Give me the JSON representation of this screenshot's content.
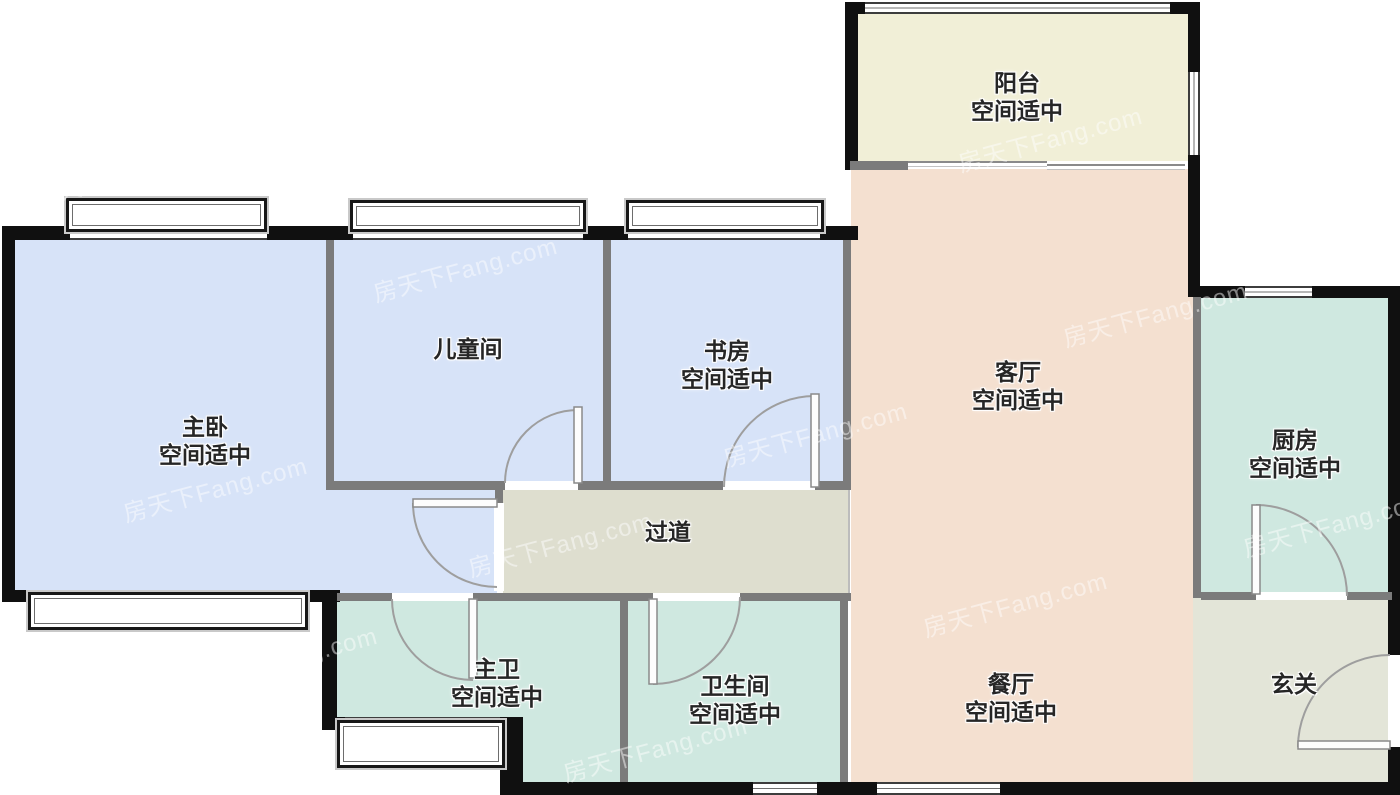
{
  "plan": {
    "watermark": "房天下Fang.com",
    "colors": {
      "bedroom": "#d7e3f8",
      "living": "#f4e0d0",
      "balcony": "#f1efd7",
      "wet": "#cfe8e0",
      "corridor": "#dedecf",
      "foyer": "#e3e5d8",
      "wall_exterior": "#101010",
      "wall_interior": "#7b7b7b"
    },
    "rooms": [
      {
        "id": "balcony",
        "name": "阳台",
        "status": "空间适中"
      },
      {
        "id": "master-bedroom",
        "name": "主卧",
        "status": "空间适中"
      },
      {
        "id": "kids-room",
        "name": "儿童间",
        "status": ""
      },
      {
        "id": "study",
        "name": "书房",
        "status": "空间适中"
      },
      {
        "id": "living-room",
        "name": "客厅",
        "status": "空间适中"
      },
      {
        "id": "kitchen",
        "name": "厨房",
        "status": "空间适中"
      },
      {
        "id": "corridor",
        "name": "过道",
        "status": ""
      },
      {
        "id": "master-bath",
        "name": "主卫",
        "status": "空间适中"
      },
      {
        "id": "bathroom",
        "name": "卫生间",
        "status": "空间适中"
      },
      {
        "id": "dining-room",
        "name": "餐厅",
        "status": "空间适中"
      },
      {
        "id": "foyer",
        "name": "玄关",
        "status": ""
      }
    ]
  }
}
